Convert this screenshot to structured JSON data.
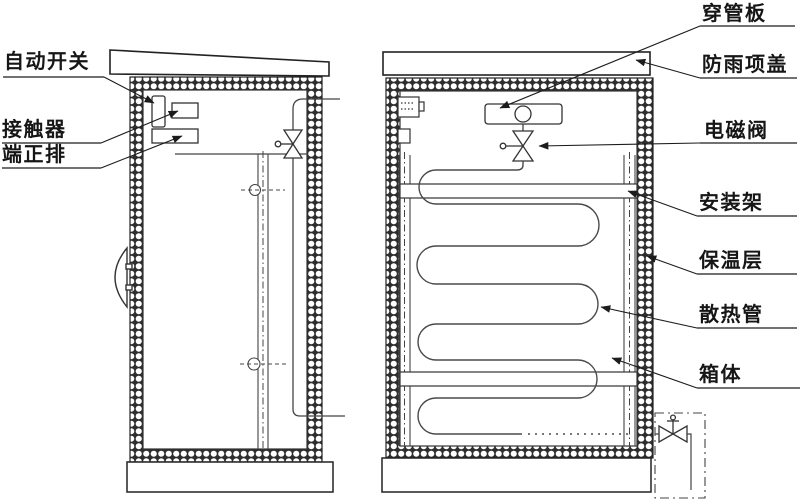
{
  "diagram": {
    "kind": "cabinet-cross-section-drawing",
    "views": {
      "left": "side-view-cabinet",
      "right": "front-view-cabinet"
    }
  },
  "labels": {
    "auto_switch": "自动开关",
    "contactor": "接触器",
    "terminal_strip": "端正排",
    "pipe_through_plate": "穿管板",
    "rain_cover": "防雨项盖",
    "solenoid_valve": "电磁阀",
    "mounting_frame": "安装架",
    "insulation_layer": "保温层",
    "heat_pipe": "散热管",
    "cabinet_body": "箱体"
  },
  "colors": {
    "background": "#ffffff",
    "line": "#3f3f3f",
    "dark_line": "#222222",
    "text": "#161616"
  }
}
